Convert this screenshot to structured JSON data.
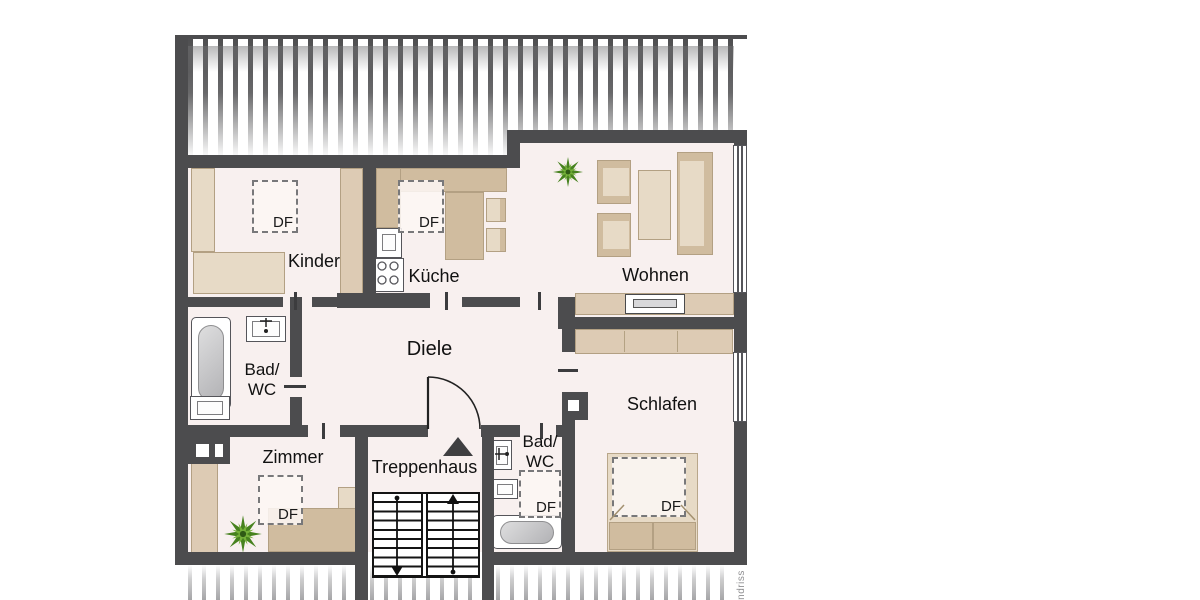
{
  "rooms": {
    "kinder": "Kinder",
    "kueche": "Küche",
    "wohnen": "Wohnen",
    "diele": "Diele",
    "zimmer": "Zimmer",
    "treppenhaus": "Treppenhaus",
    "schlafen": "Schlafen",
    "bad_wc_1_line1": "Bad/",
    "bad_wc_1_line2": "WC",
    "bad_wc_2_line1": "Bad/",
    "bad_wc_2_line2": "WC"
  },
  "skylight_label": "DF",
  "watermark": "Grundriss",
  "colors": {
    "wall": "#4c4c4e",
    "floor": "#f8f0ef",
    "furniture": "#ddcbb4",
    "furniture_dark": "#d0bc9f",
    "furniture_light": "#e7dac6",
    "plant_dark": "#47821f",
    "plant_light": "#76b13a",
    "roof_stripe_top": "#4e4e50",
    "roof_stripe_bottom": "#a6a6a8"
  }
}
